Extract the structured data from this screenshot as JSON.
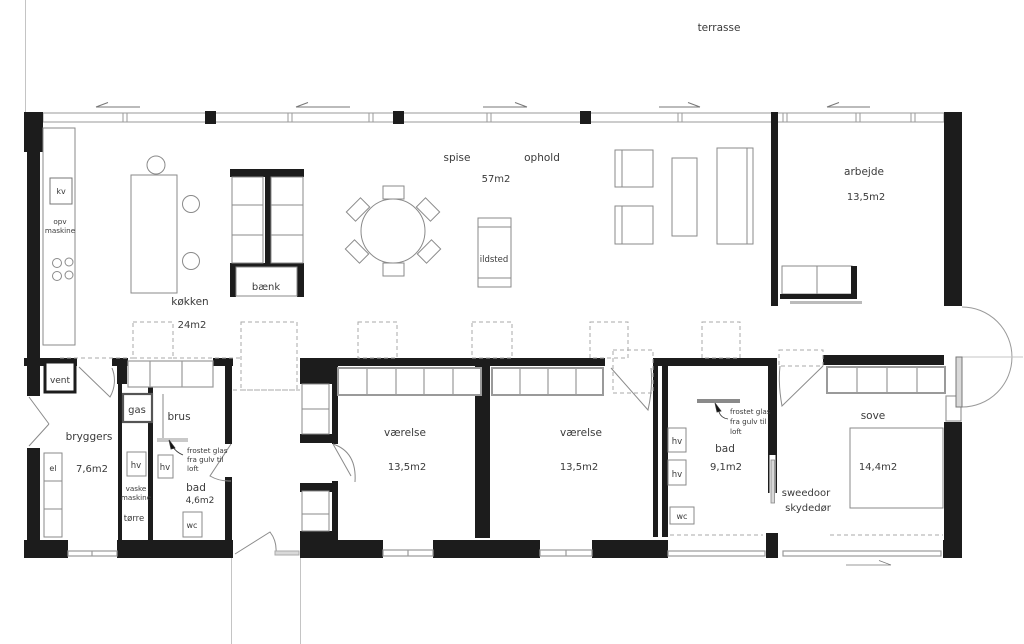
{
  "title": "floor plan",
  "labels": {
    "terrasse": "terrasse",
    "kokken": "køkken",
    "kokken_area": "24m2",
    "spise": "spise",
    "ophold": "ophold",
    "living_area": "57m2",
    "arbejde": "arbejde",
    "arbejde_area": "13,5m2",
    "vent": "vent",
    "bryggers": "bryggers",
    "bryggers_area": "7,6m2",
    "brus": "brus",
    "bad_small": "bad",
    "bad_small_area": "4,6m2",
    "varelse1": "værelse",
    "varelse1_area": "13,5m2",
    "varelse2": "værelse",
    "varelse2_area": "13,5m2",
    "bad_master": "bad",
    "bad_master_area": "9,1m2",
    "sove": "sove",
    "sove_area": "14,4m2",
    "bank": "bænk",
    "ildsted": "ildsted",
    "kv": "kv",
    "opv_line1": "opv",
    "opv_line2": "maskine",
    "el": "el",
    "gas": "gas",
    "hv": "hv",
    "wc": "wc",
    "vaske_line1": "vaske",
    "vaske_line2": "maskine",
    "torre": "tørre",
    "sweedoor_line1": "sweedoor",
    "sweedoor_line2": "skydedør",
    "frost_line1": "frostet glas",
    "frost_line2": "fra gulv til",
    "frost_line3": "loft"
  },
  "colors": {
    "wall": "#1c1c1c",
    "furniture": "#8a8a8a",
    "glass": "#9a9a9a",
    "dashed": "#aaaaaa",
    "text": "#3a3a3a",
    "background": "#ffffff"
  }
}
